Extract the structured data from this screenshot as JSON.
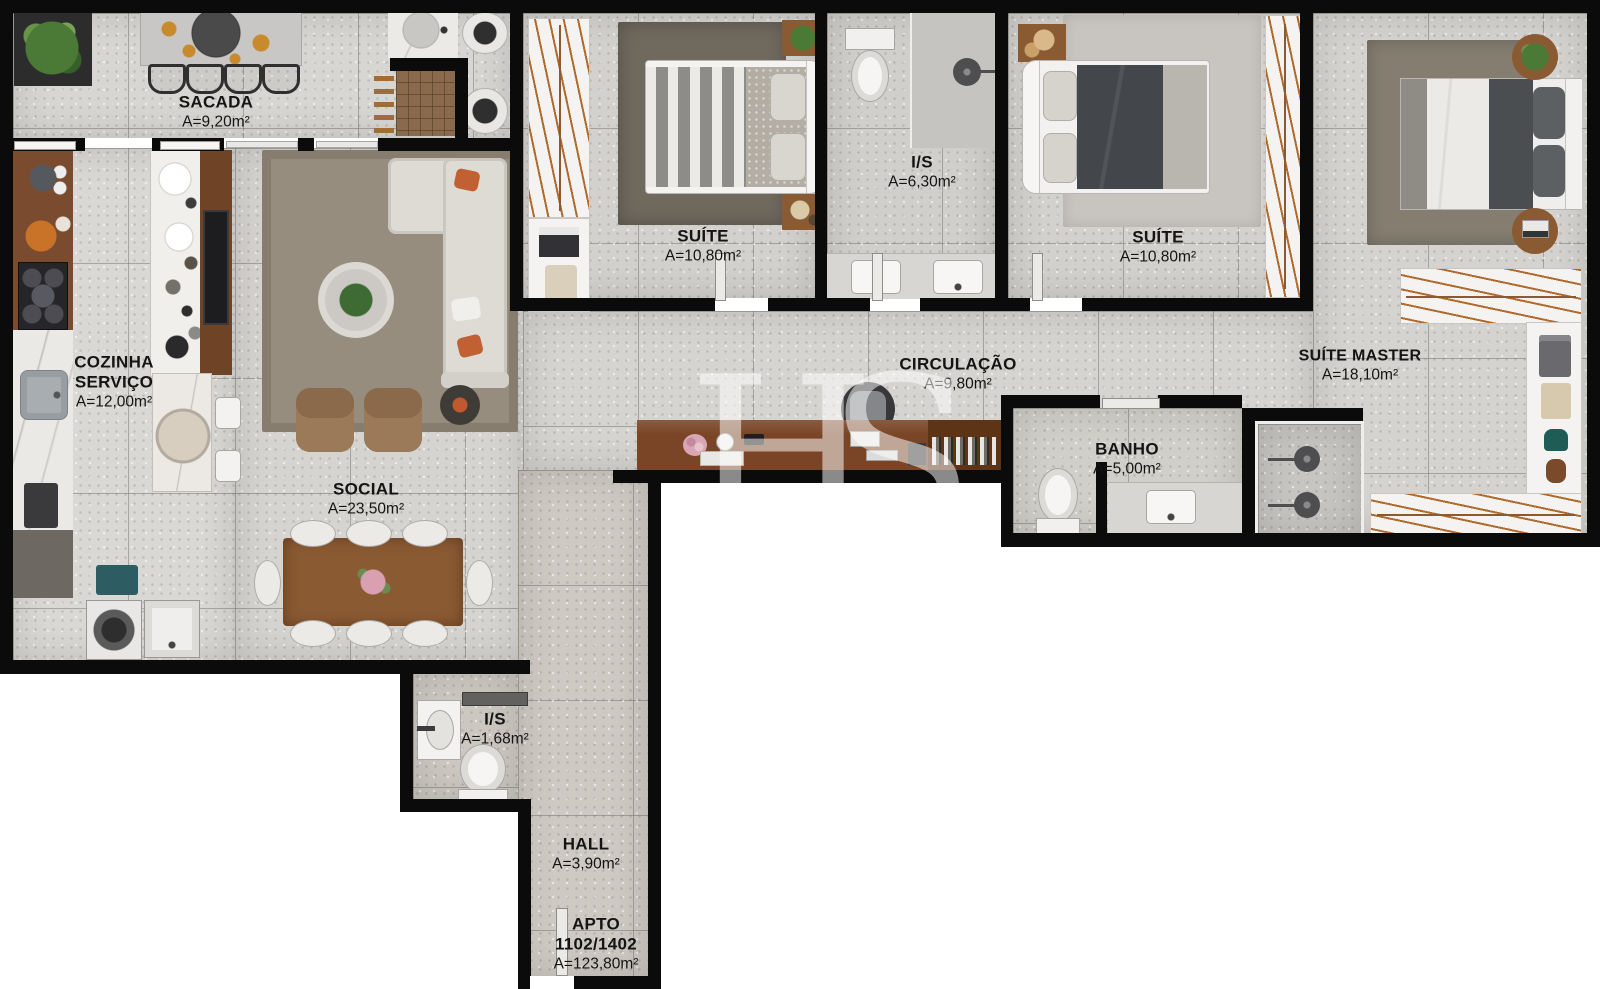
{
  "watermark": {
    "text": "HS"
  },
  "rooms": {
    "sacada": {
      "label": "SACADA",
      "area": "A=9,20m²"
    },
    "cozinha": {
      "l1": "COZINHA",
      "l2": "SERVIÇO",
      "area": "A=12,00m²"
    },
    "social": {
      "label": "SOCIAL",
      "area": "A=23,50m²"
    },
    "suite1": {
      "label": "SUÍTE",
      "area": "A=10,80m²"
    },
    "is_suite": {
      "label": "I/S",
      "area": "A=6,30m²"
    },
    "suite2": {
      "label": "SUÍTE",
      "area": "A=10,80m²"
    },
    "master": {
      "label": "SUÍTE MASTER",
      "area": "A=18,10m²"
    },
    "circulacao": {
      "label": "CIRCULAÇÃO",
      "area": "A=9,80m²"
    },
    "banho": {
      "label": "BANHO",
      "area": "A=5,00m²"
    },
    "is_hall": {
      "label": "I/S",
      "area": "A=1,68m²"
    },
    "hall": {
      "label": "HALL",
      "area": "A=3,90m²"
    },
    "apto": {
      "l1": "APTO",
      "l2": "1102/1402",
      "area": "A=123,80m²"
    }
  },
  "colors": {
    "wall": "#0b0b0b",
    "wood": "#8a5a33",
    "closet_rail": "#b06a2c"
  }
}
